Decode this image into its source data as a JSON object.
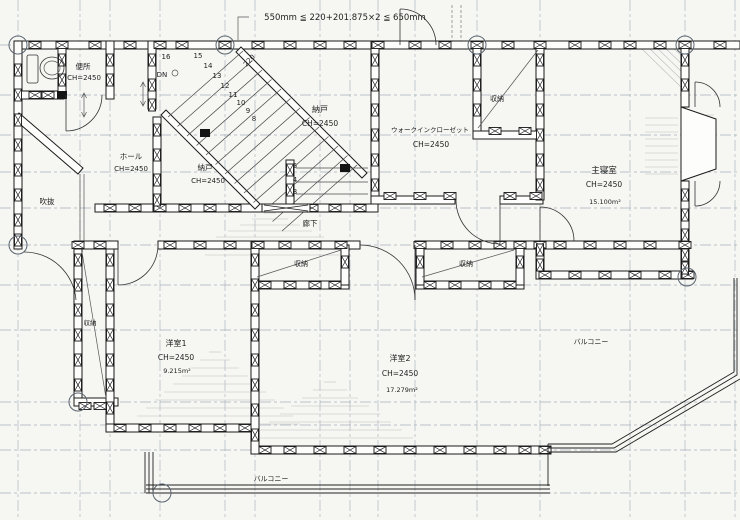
{
  "drawing": {
    "annotation_top": "550mm ≦ 220+201.875×2 ≦ 650mm",
    "dim_220": "220",
    "stair": {
      "dn": "DN",
      "numbers": [
        "16",
        "15",
        "14",
        "13",
        "12",
        "11",
        "10",
        "9",
        "8",
        "5",
        "4",
        "3"
      ]
    },
    "rooms": {
      "toilet": {
        "name": "便所",
        "ch": "CH=2450"
      },
      "storage_top": {
        "name": "納戸",
        "ch": "CH=2450"
      },
      "walk_in_closet": {
        "name": "ウォークインクローゼット",
        "ch": "CH=2450"
      },
      "closet_wic": {
        "name": "収納"
      },
      "master_bedroom": {
        "name": "主寝室",
        "ch": "CH=2450",
        "area": "15.100m²"
      },
      "hall": {
        "name": "ホール",
        "ch": "CH=2450"
      },
      "storage_left": {
        "name": "納戸",
        "ch": "CH=2450"
      },
      "void": {
        "name": "吹抜"
      },
      "corridor": {
        "name": "廊下"
      },
      "closet_corridor_left": {
        "name": "収納"
      },
      "closet_corridor_right": {
        "name": "収納"
      },
      "closet_west": {
        "name": "収納"
      },
      "western_room_1": {
        "name": "洋室1",
        "ch": "CH=2450",
        "area": "9.215m²"
      },
      "western_room_2": {
        "name": "洋室2",
        "ch": "CH=2450",
        "area": "17.279m²"
      },
      "balcony_bottom": {
        "name": "バルコニー"
      },
      "balcony_right": {
        "name": "バルコニー"
      }
    }
  }
}
